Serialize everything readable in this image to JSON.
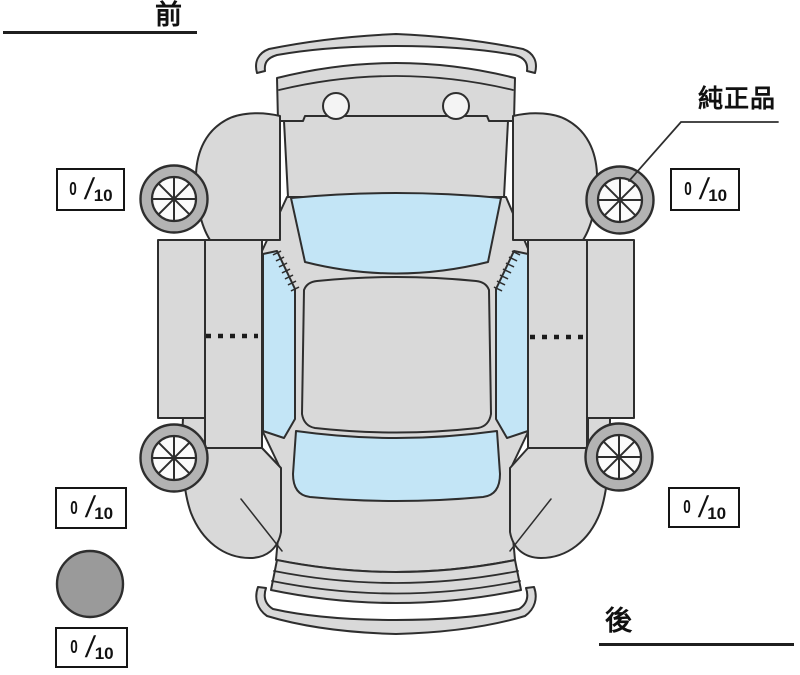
{
  "labels": {
    "front": "前",
    "rear": "後",
    "genuine_part": "純正品"
  },
  "tread_scores": {
    "front_left": {
      "value": "0",
      "separator": "/",
      "max": "10"
    },
    "front_right": {
      "value": "0",
      "separator": "/",
      "max": "10"
    },
    "rear_left": {
      "value": "0",
      "separator": "/",
      "max": "10"
    },
    "rear_right": {
      "value": "0",
      "separator": "/",
      "max": "10"
    },
    "spare": {
      "value": "0",
      "separator": "/",
      "max": "10"
    }
  },
  "icons": {
    "car": "car-top-view",
    "wheels": "wheel-icon",
    "spare_tire": "spare-tire-icon"
  },
  "colors": {
    "body": "#d9d9d9",
    "glass": "#c3e5f6",
    "tire_ring": "#b3b3b3",
    "wheel_rim": "#fbfbfb",
    "spare_tire": "#9a9a9a",
    "outline": "#2e2e2e",
    "background": "#ffffff"
  }
}
